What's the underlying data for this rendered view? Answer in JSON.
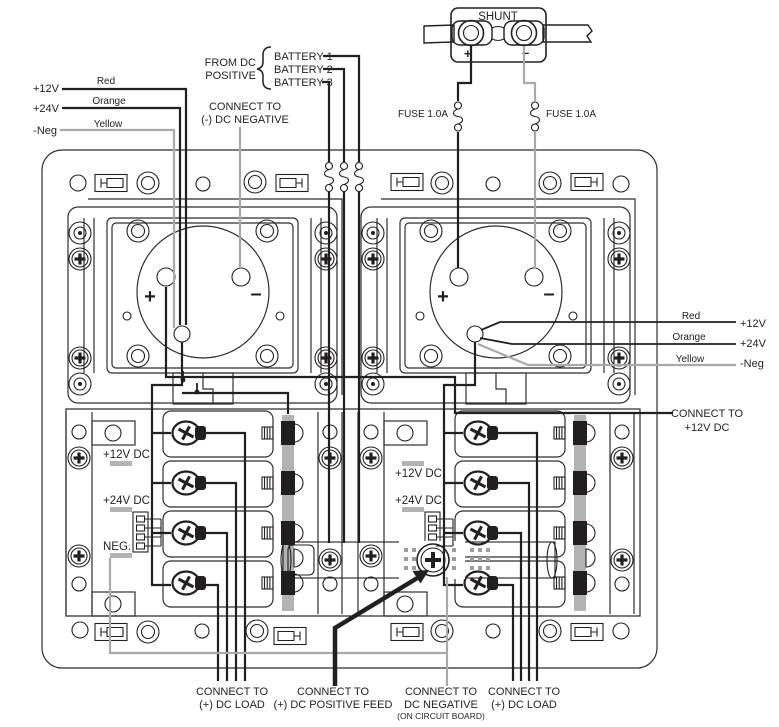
{
  "colors": {
    "line": "#231f20",
    "gray_wire": "#a7a9ac",
    "gray_fill": "#b1b3b5",
    "background": "#ffffff"
  },
  "shunt": {
    "label": "SHUNT",
    "plus": "+",
    "minus": "–"
  },
  "fuses": {
    "left": "FUSE 1.0A",
    "right": "FUSE 1.0A"
  },
  "source": {
    "line1": "FROM DC",
    "line2": "POSITIVE",
    "battery1": "BATTERY 1",
    "battery2": "BATTERY 2",
    "battery3": "BATTERY 3"
  },
  "legend_left": {
    "v12": "+12V",
    "v12_color": "Red",
    "v24": "+24V",
    "v24_color": "Orange",
    "neg": "-Neg",
    "neg_color": "Yellow"
  },
  "legend_right": {
    "v12_color": "Red",
    "v12": "+12V",
    "v24_color": "Orange",
    "v24": "+24V",
    "neg_color": "Yellow",
    "neg": "-Neg"
  },
  "note_negative": {
    "line1": "CONNECT TO",
    "line2": "(-) DC NEGATIVE"
  },
  "note_12v": {
    "line1": "CONNECT TO",
    "line2": "+12V DC"
  },
  "meter": {
    "plus": "+",
    "minus": "–"
  },
  "terminals_left": {
    "v12": "+12V DC",
    "v24": "+24V DC",
    "neg": "NEG."
  },
  "terminals_right": {
    "v12": "+12V DC",
    "v24": "+24V DC"
  },
  "bottom": {
    "load_left": {
      "line1": "CONNECT TO",
      "line2": "(+) DC LOAD"
    },
    "positive_feed": {
      "line1": "CONNECT TO",
      "line2": "(+) DC POSITIVE FEED"
    },
    "negative": {
      "line1": "CONNECT TO",
      "line2": "DC NEGATIVE",
      "line3": "(ON CIRCUIT BOARD)"
    },
    "load_right": {
      "line1": "CONNECT TO",
      "line2": "(+) DC LOAD"
    }
  }
}
